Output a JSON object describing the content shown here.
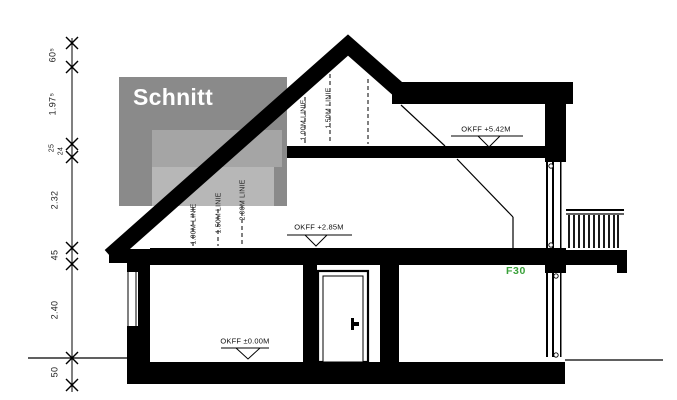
{
  "drawing": {
    "overlay": {
      "title": "Schnitt"
    },
    "annotations": {
      "fire_rating": "F30",
      "level_labels": [
        {
          "text": "OKFF +5.42M"
        },
        {
          "text": "OKFF +2.85M"
        },
        {
          "text": "OKFF ±0.00M"
        }
      ],
      "height_line_labels_upper": [
        "1.00M LINIE",
        "1.50M LINIE",
        "2.00M LINIE"
      ],
      "height_line_labels_attic": [
        "1.00M LINIE",
        "1.50M LINIE"
      ],
      "dimension_chain": [
        {
          "value": "60⁵"
        },
        {
          "value": "1.97⁵"
        },
        {
          "value": "25"
        },
        {
          "value": "24"
        },
        {
          "value": "2.32"
        },
        {
          "value": "45"
        },
        {
          "value": "2.40"
        },
        {
          "value": "50"
        }
      ]
    },
    "colors": {
      "line": "#000000",
      "overlay_dark": "#8a8a8a",
      "overlay_mid": "#a5a5a5",
      "overlay_light": "#b7b7b7",
      "fire_rating_green": "#3aa13a",
      "title_text": "#ffffff"
    }
  }
}
